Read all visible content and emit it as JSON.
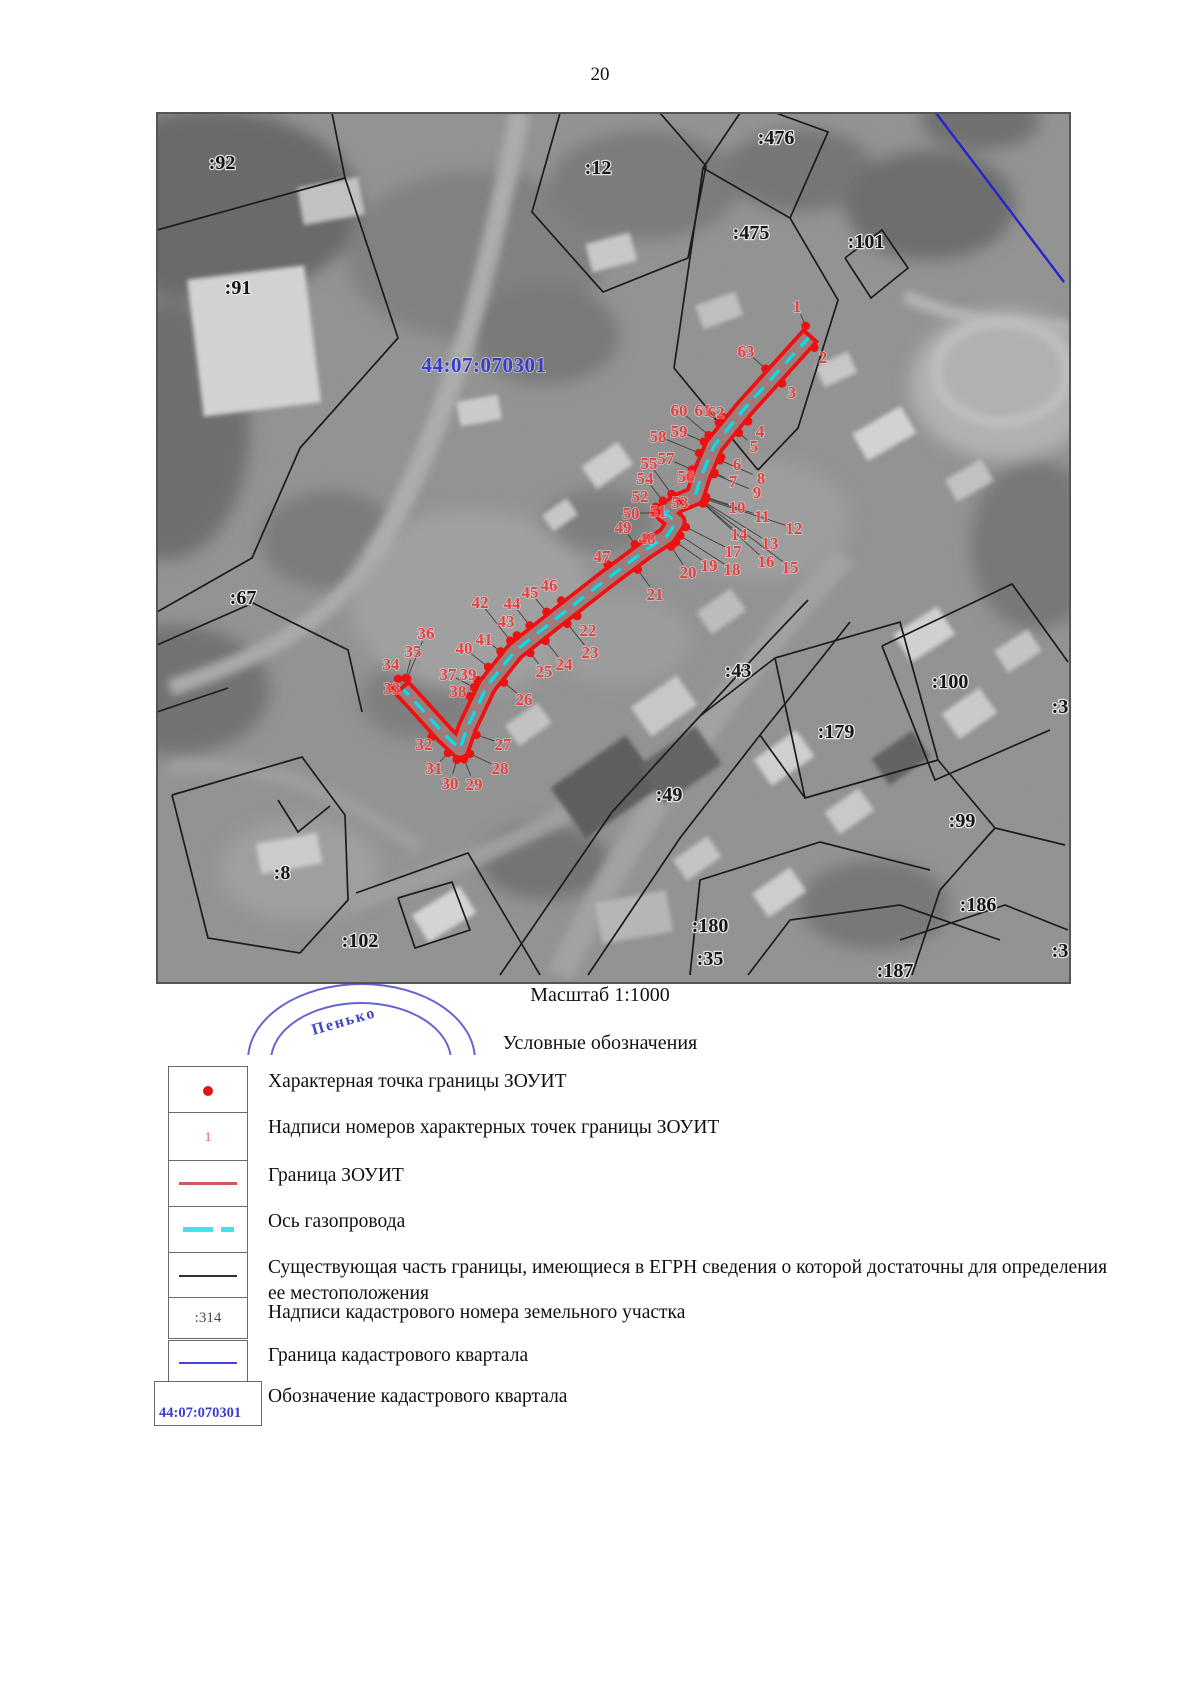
{
  "page": {
    "number": "20"
  },
  "map": {
    "scale_label": "Масштаб 1:1000",
    "stamp_text": "Пенько",
    "quarter_label": {
      "text": "44:07:070301",
      "x": 484,
      "y": 372
    },
    "parcel_labels": [
      {
        "text": ":92",
        "x": 222,
        "y": 162
      },
      {
        "text": ":12",
        "x": 598,
        "y": 167
      },
      {
        "text": ":476",
        "x": 776,
        "y": 137
      },
      {
        "text": ":475",
        "x": 751,
        "y": 232
      },
      {
        "text": ":101",
        "x": 866,
        "y": 241
      },
      {
        "text": ":91",
        "x": 238,
        "y": 287
      },
      {
        "text": ":67",
        "x": 243,
        "y": 597
      },
      {
        "text": ":43",
        "x": 738,
        "y": 670
      },
      {
        "text": ":100",
        "x": 950,
        "y": 681
      },
      {
        "text": ":179",
        "x": 836,
        "y": 731
      },
      {
        "text": ":49",
        "x": 669,
        "y": 794
      },
      {
        "text": ":99",
        "x": 962,
        "y": 820
      },
      {
        "text": ":186",
        "x": 978,
        "y": 904
      },
      {
        "text": ":8",
        "x": 282,
        "y": 872
      },
      {
        "text": ":102",
        "x": 360,
        "y": 940
      },
      {
        "text": ":180",
        "x": 710,
        "y": 925
      },
      {
        "text": ":35",
        "x": 710,
        "y": 958
      },
      {
        "text": ":187",
        "x": 895,
        "y": 970
      },
      {
        "text": ":3",
        "x": 1060,
        "y": 706
      },
      {
        "text": ":3",
        "x": 1060,
        "y": 950
      }
    ],
    "blue_boundary": [
      [
        936,
        113
      ],
      [
        1064,
        282
      ]
    ],
    "boundary_lines": [
      [
        [
          332,
          113
        ],
        [
          345,
          178
        ],
        [
          157,
          230
        ]
      ],
      [
        [
          345,
          178
        ],
        [
          398,
          338
        ],
        [
          300,
          448
        ],
        [
          252,
          558
        ],
        [
          157,
          612
        ]
      ],
      [
        [
          560,
          113
        ],
        [
          532,
          212
        ],
        [
          603,
          292
        ],
        [
          688,
          258
        ],
        [
          706,
          166
        ],
        [
          660,
          113
        ]
      ],
      [
        [
          740,
          113
        ],
        [
          703,
          168
        ],
        [
          790,
          218
        ],
        [
          828,
          132
        ],
        [
          776,
          113
        ]
      ],
      [
        [
          703,
          168
        ],
        [
          674,
          368
        ],
        [
          758,
          470
        ]
      ],
      [
        [
          790,
          218
        ],
        [
          838,
          300
        ],
        [
          798,
          428
        ],
        [
          758,
          470
        ]
      ],
      [
        [
          845,
          258
        ],
        [
          882,
          230
        ],
        [
          908,
          268
        ],
        [
          871,
          298
        ],
        [
          845,
          258
        ]
      ],
      [
        [
          157,
          645
        ],
        [
          253,
          603
        ],
        [
          348,
          650
        ],
        [
          362,
          712
        ]
      ],
      [
        [
          157,
          712
        ],
        [
          228,
          688
        ]
      ],
      [
        [
          172,
          795
        ],
        [
          302,
          757
        ],
        [
          345,
          815
        ],
        [
          348,
          900
        ],
        [
          300,
          953
        ],
        [
          208,
          938
        ],
        [
          172,
          795
        ]
      ],
      [
        [
          278,
          800
        ],
        [
          298,
          832
        ],
        [
          330,
          806
        ]
      ],
      [
        [
          356,
          893
        ],
        [
          468,
          853
        ],
        [
          540,
          975
        ]
      ],
      [
        [
          398,
          898
        ],
        [
          452,
          882
        ],
        [
          470,
          930
        ],
        [
          415,
          948
        ],
        [
          398,
          898
        ]
      ],
      [
        [
          500,
          975
        ],
        [
          612,
          812
        ],
        [
          700,
          716
        ],
        [
          770,
          640
        ],
        [
          808,
          600
        ]
      ],
      [
        [
          588,
          975
        ],
        [
          680,
          838
        ],
        [
          760,
          735
        ],
        [
          820,
          660
        ],
        [
          850,
          622
        ]
      ],
      [
        [
          700,
          716
        ],
        [
          775,
          658
        ]
      ],
      [
        [
          775,
          658
        ],
        [
          900,
          622
        ],
        [
          938,
          760
        ],
        [
          805,
          798
        ],
        [
          775,
          658
        ]
      ],
      [
        [
          882,
          646
        ],
        [
          1012,
          584
        ],
        [
          1068,
          662
        ]
      ],
      [
        [
          882,
          646
        ],
        [
          935,
          780
        ],
        [
          1050,
          730
        ]
      ],
      [
        [
          938,
          760
        ],
        [
          995,
          828
        ],
        [
          1065,
          845
        ]
      ],
      [
        [
          912,
          975
        ],
        [
          940,
          890
        ],
        [
          995,
          828
        ]
      ],
      [
        [
          690,
          975
        ],
        [
          700,
          880
        ],
        [
          820,
          842
        ],
        [
          930,
          870
        ]
      ],
      [
        [
          748,
          975
        ],
        [
          790,
          920
        ],
        [
          900,
          905
        ],
        [
          1000,
          940
        ]
      ],
      [
        [
          900,
          940
        ],
        [
          1005,
          905
        ],
        [
          1068,
          930
        ]
      ],
      [
        [
          760,
          735
        ],
        [
          805,
          798
        ]
      ]
    ],
    "corridor_centerline": [
      [
        810,
        336
      ],
      [
        744,
        409
      ],
      [
        714,
        446
      ],
      [
        702,
        474
      ],
      [
        695,
        496
      ],
      [
        678,
        503
      ],
      [
        665,
        513
      ],
      [
        676,
        522
      ],
      [
        667,
        536
      ],
      [
        647,
        549
      ],
      [
        608,
        578
      ],
      [
        558,
        617
      ],
      [
        515,
        651
      ],
      [
        487,
        686
      ],
      [
        467,
        728
      ],
      [
        460,
        749
      ],
      [
        445,
        735
      ],
      [
        417,
        704
      ],
      [
        402,
        688
      ]
    ],
    "zouit_points": [
      {
        "n": "1",
        "x": 797,
        "y": 306
      },
      {
        "n": "2",
        "x": 823,
        "y": 357
      },
      {
        "n": "3",
        "x": 792,
        "y": 392
      },
      {
        "n": "4",
        "x": 760,
        "y": 431
      },
      {
        "n": "5",
        "x": 754,
        "y": 446
      },
      {
        "n": "6",
        "x": 737,
        "y": 464
      },
      {
        "n": "7",
        "x": 733,
        "y": 481
      },
      {
        "n": "8",
        "x": 761,
        "y": 478
      },
      {
        "n": "9",
        "x": 757,
        "y": 492
      },
      {
        "n": "10",
        "x": 737,
        "y": 507
      },
      {
        "n": "11",
        "x": 762,
        "y": 516
      },
      {
        "n": "12",
        "x": 794,
        "y": 528
      },
      {
        "n": "13",
        "x": 770,
        "y": 543
      },
      {
        "n": "14",
        "x": 739,
        "y": 534
      },
      {
        "n": "15",
        "x": 790,
        "y": 567
      },
      {
        "n": "16",
        "x": 766,
        "y": 561
      },
      {
        "n": "17",
        "x": 733,
        "y": 551
      },
      {
        "n": "18",
        "x": 732,
        "y": 569
      },
      {
        "n": "19",
        "x": 709,
        "y": 565
      },
      {
        "n": "20",
        "x": 688,
        "y": 572
      },
      {
        "n": "21",
        "x": 655,
        "y": 594
      },
      {
        "n": "22",
        "x": 588,
        "y": 630
      },
      {
        "n": "23",
        "x": 590,
        "y": 652
      },
      {
        "n": "24",
        "x": 564,
        "y": 664
      },
      {
        "n": "25",
        "x": 544,
        "y": 671
      },
      {
        "n": "26",
        "x": 524,
        "y": 699
      },
      {
        "n": "27",
        "x": 503,
        "y": 744
      },
      {
        "n": "28",
        "x": 500,
        "y": 768
      },
      {
        "n": "29",
        "x": 474,
        "y": 784
      },
      {
        "n": "30",
        "x": 450,
        "y": 783
      },
      {
        "n": "31",
        "x": 434,
        "y": 768
      },
      {
        "n": "32",
        "x": 424,
        "y": 744
      },
      {
        "n": "33",
        "x": 392,
        "y": 688
      },
      {
        "n": "34",
        "x": 391,
        "y": 664
      },
      {
        "n": "35",
        "x": 413,
        "y": 651
      },
      {
        "n": "36",
        "x": 426,
        "y": 633
      },
      {
        "n": "37",
        "x": 448,
        "y": 674
      },
      {
        "n": "38",
        "x": 458,
        "y": 691
      },
      {
        "n": "39",
        "x": 468,
        "y": 674
      },
      {
        "n": "40",
        "x": 464,
        "y": 648
      },
      {
        "n": "41",
        "x": 484,
        "y": 639
      },
      {
        "n": "42",
        "x": 480,
        "y": 602
      },
      {
        "n": "43",
        "x": 506,
        "y": 621
      },
      {
        "n": "44",
        "x": 512,
        "y": 603
      },
      {
        "n": "45",
        "x": 530,
        "y": 592
      },
      {
        "n": "46",
        "x": 549,
        "y": 585
      },
      {
        "n": "47",
        "x": 602,
        "y": 556
      },
      {
        "n": "48",
        "x": 647,
        "y": 538
      },
      {
        "n": "49",
        "x": 623,
        "y": 527
      },
      {
        "n": "50",
        "x": 631,
        "y": 513
      },
      {
        "n": "51",
        "x": 658,
        "y": 511
      },
      {
        "n": "52",
        "x": 640,
        "y": 496
      },
      {
        "n": "53",
        "x": 680,
        "y": 502
      },
      {
        "n": "54",
        "x": 645,
        "y": 478
      },
      {
        "n": "55",
        "x": 649,
        "y": 463
      },
      {
        "n": "56",
        "x": 686,
        "y": 476
      },
      {
        "n": "57",
        "x": 666,
        "y": 458
      },
      {
        "n": "58",
        "x": 658,
        "y": 436
      },
      {
        "n": "59",
        "x": 679,
        "y": 431
      },
      {
        "n": "60",
        "x": 679,
        "y": 410
      },
      {
        "n": "61",
        "x": 703,
        "y": 410
      },
      {
        "n": "62",
        "x": 716,
        "y": 412
      },
      {
        "n": "63",
        "x": 746,
        "y": 351
      }
    ]
  },
  "legend": {
    "title": "Условные обозначения",
    "rows": [
      {
        "y": 1066,
        "h": 47,
        "symbol": "point",
        "symbol_text": "",
        "label": "Характерная точка границы ЗОУИТ"
      },
      {
        "y": 1112,
        "h": 47,
        "symbol": "point_number",
        "symbol_text": "1",
        "label": "Надписи номеров характерных точек границы ЗОУИТ"
      },
      {
        "y": 1160,
        "h": 45,
        "symbol": "red_line",
        "symbol_text": "",
        "label": "Граница ЗОУИТ"
      },
      {
        "y": 1206,
        "h": 45,
        "symbol": "cyan_dashed",
        "symbol_text": "",
        "label": "Ось газопровода"
      },
      {
        "y": 1252,
        "h": 45,
        "symbol": "black_line",
        "symbol_text": "",
        "label": "Существующая часть границы, имеющиеся в ЕГРН сведения о которой достаточны для определения ее местоположения"
      },
      {
        "y": 1297,
        "h": 40,
        "symbol": "cadastral_number",
        "symbol_text": ":314",
        "label": "Надписи кадастрового номера земельного участка"
      },
      {
        "y": 1340,
        "h": 44,
        "symbol": "blue_line",
        "symbol_text": "",
        "label": "Граница кадастрового квартала"
      },
      {
        "y": 1381,
        "h": 43,
        "symbol": "quarter_designation",
        "symbol_text": "44:07:070301",
        "label": "Обозначение кадастрового квартала"
      }
    ]
  },
  "colors": {
    "zouit_red": "#ee1111",
    "axis_cyan": "#00e0ea",
    "point_label_red": "#e64040",
    "parcel_black": "#1c1c1c",
    "quarter_blue": "#3c3ccc",
    "quarter_line_blue": "#2525cf",
    "corridor_core_gray": "#8f8f8f"
  }
}
